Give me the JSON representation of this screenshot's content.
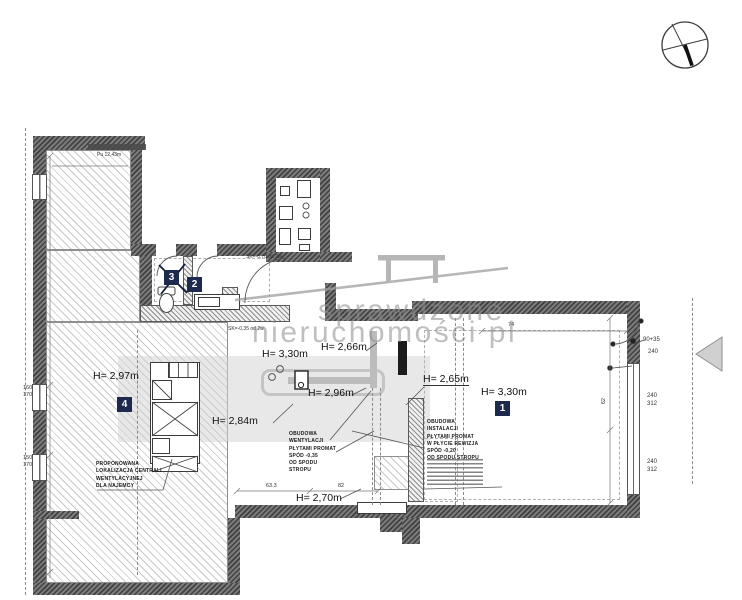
{
  "watermark": {
    "line1": "sprawdzone",
    "line2": "nieruchomości pl"
  },
  "heights": {
    "h297": "H= 2,97m",
    "h330a": "H= 3,30m",
    "h266": "H= 2,66m",
    "h296": "H= 2,96m",
    "h284": "H= 2,84m",
    "h265": "H= 2,65m",
    "h330b": "H= 3,30m",
    "h270": "H= 2,70m"
  },
  "rooms": {
    "r1": "1",
    "r2": "2",
    "r3": "3",
    "r4": "4"
  },
  "annotations": {
    "vent_enclosure": "OBUDOWA\nWENTYLACJI\nPŁYTAMI PROMAT\nSPÓD -0,35\nOD SPODU\nSTROPU",
    "inst_enclosure": "OBUDOWA\nINSTALACJI\nPŁYTAMI PROMAT\nW PŁYCIE REWIZJA\nSPÓD -0,20\nOD SPODU STROPU",
    "ahu_proposal": "PROPONOWANA\nLOKALIZACJA CENTRALI\nWENTYLACYJNEJ\nDLA NAJEMCY",
    "sk_70": "SK=-0,70 od 2w.",
    "sk_35": "SK=-0,35 od 2w",
    "area_note": "Pu 12,43m"
  },
  "dims": {
    "win_left_top": "160\n170",
    "win_left_bottom": "150\n170",
    "door_right_a": "90+35",
    "door_right_b": "240",
    "win_right_1": "240\n312",
    "win_right_2": "240\n312",
    "d74": "74",
    "d633": "63.3",
    "d82": "82",
    "d62": "62"
  },
  "colors": {
    "wall": "#4a4a4a",
    "room_label_bg": "#1d2a4e",
    "watermark_gray": "#8a8a8a",
    "ceiling_band_gray": "#bcbcbc"
  }
}
